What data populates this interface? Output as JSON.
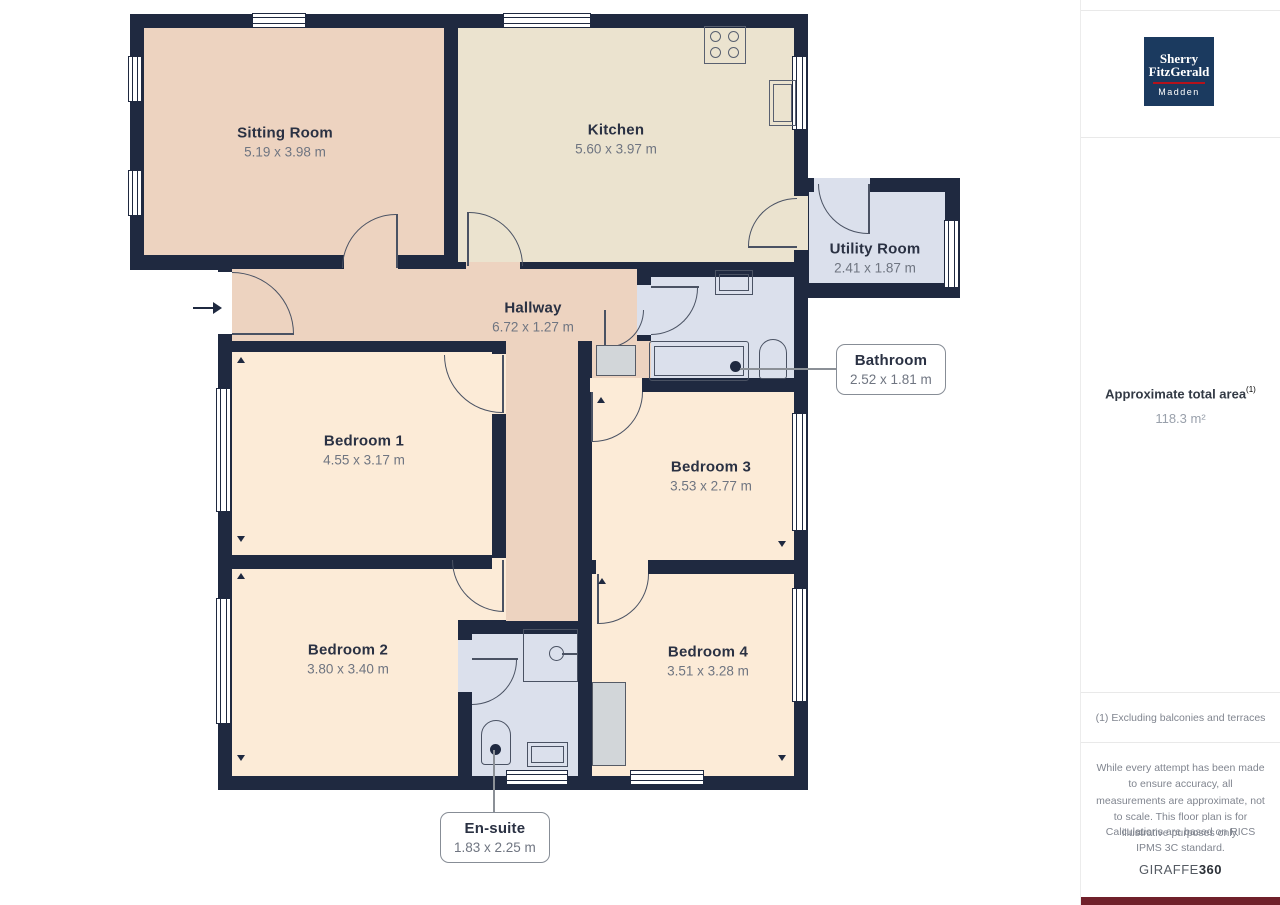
{
  "plan": {
    "rooms": [
      {
        "name": "Sitting Room",
        "dims": "5.19 x 3.98 m"
      },
      {
        "name": "Kitchen",
        "dims": "5.60 x 3.97 m"
      },
      {
        "name": "Utility Room",
        "dims": "2.41 x 1.87 m"
      },
      {
        "name": "Hallway",
        "dims": "6.72 x 1.27 m"
      },
      {
        "name": "Bedroom 1",
        "dims": "4.55 x 3.17 m"
      },
      {
        "name": "Bedroom 3",
        "dims": "3.53 x 2.77 m"
      },
      {
        "name": "Bedroom 2",
        "dims": "3.80 x 3.40 m"
      },
      {
        "name": "Bedroom 4",
        "dims": "3.51 x 3.28 m"
      }
    ],
    "callouts": [
      {
        "name": "Bathroom",
        "dims": "2.52 x 1.81 m"
      },
      {
        "name": "En-suite",
        "dims": "1.83 x 2.25 m"
      }
    ],
    "colors": {
      "wall": "#1f2940",
      "living_floor": "#edd3c0",
      "kitchen_floor": "#ebe3cf",
      "bedroom_floor": "#fcebd7",
      "wet_room_floor": "#dbe0ec"
    }
  },
  "sidebar": {
    "logo": {
      "line1": "Sherry",
      "line2": "FitzGerald",
      "line3": "Madden",
      "bg": "#1b3a5f",
      "rule": "#b5121b"
    },
    "area_label": "Approximate total area",
    "area_superscript": "(1)",
    "area_value": "118.3 m²",
    "footnote": "(1) Excluding balconies and terraces",
    "disclaimer1": "While every attempt has been made to ensure accuracy, all measurements are approximate, not to scale. This floor plan is for illustrative purposes only.",
    "disclaimer2": "Calculations are based on RICS IPMS 3C standard.",
    "brand": {
      "part1": "GIRAFFE",
      "part2": "360"
    }
  }
}
